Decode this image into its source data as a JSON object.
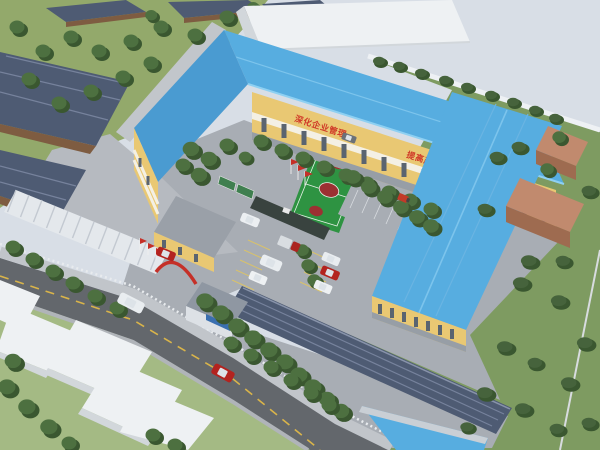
{
  "scene": {
    "type": "aerial-3d-architectural-rendering",
    "subject": "factory campus with blue metal roofs, central basketball court, parking lots, perimeter road and landscaping"
  },
  "building_slogan": {
    "part1": "深化企业管理",
    "part2": "提高产品质量"
  },
  "palette": {
    "sky": "#d8dee6",
    "grass1": "#93a96b",
    "grass2": "#a4ba84",
    "grass3": "#7e9b61",
    "roofBlue": "#57ade0",
    "roofBlueDeep": "#4a9bd1",
    "wallYellow": "#e9c873",
    "bandWhite": "#f4f0e4",
    "baseGray": "#979ea6",
    "windowDark": "#5a6470",
    "darkRoof": "#4e5b73",
    "darkRoofLine": "#76829c",
    "trimBrown": "#7e5c41",
    "pave": "#a8adb4",
    "paveLight": "#c2c6cb",
    "yard": "#b6bac0",
    "road": "#63676c",
    "roadLine": "#d9b44a",
    "curb": "#c1c5ca",
    "fence": "#e8ebee",
    "courtGreen": "#2e9342",
    "courtRed": "#9c3032",
    "lineWhite": "#e8f0e8",
    "tree": "#4d7040",
    "treeDark": "#3a5730",
    "bush": "#46633c",
    "boxWhite": "#eef1f3",
    "boxSide": "#d2d7db",
    "brickWall": "#9e6b50",
    "brickRoof": "#c18a6e",
    "red": "#c53028",
    "signBlue": "#3a6fb0",
    "boardGreen": "#3f7f4f",
    "canopy": "#e4e8ec",
    "canopyRib": "#c3c9d1",
    "slogan": "#d03a28"
  }
}
